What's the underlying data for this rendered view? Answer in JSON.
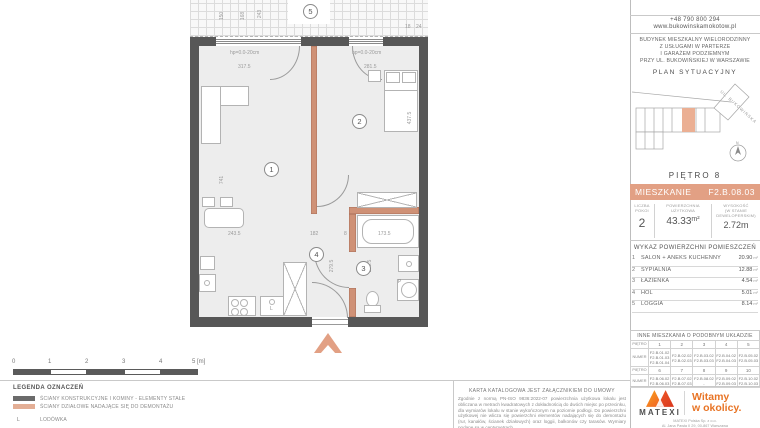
{
  "colors": {
    "accent_salmon": "#E2A084",
    "partition_salmon": "#CF9176",
    "wall_dark": "#575757",
    "logo_orange_1": "#F28C00",
    "logo_orange_2": "#E84E1B",
    "tagline_orange": "#E87425"
  },
  "plan": {
    "room_numbers": [
      "1",
      "2",
      "3",
      "4",
      "5"
    ],
    "dims": {
      "hp_left": "hp=0.0-20cm",
      "hp_right": "hp=0.0-20cm",
      "top_left": "317.5",
      "top_right": "281.5",
      "left_height": "741",
      "right_height": "437.5",
      "bottom_1": "243.5",
      "bottom_2": "182",
      "bottom_3": "8",
      "bottom_4": "173.5",
      "vert_1": "279.5",
      "vert_2": "273.5",
      "loggia_1": "150",
      "loggia_2": "168",
      "loggia_3": "243",
      "loggia_4": "18",
      "loggia_5": "24"
    },
    "labels": {
      "fridge": "L",
      "washer": "P"
    }
  },
  "scalebar": {
    "labels": [
      "0",
      "1",
      "2",
      "3",
      "4"
    ],
    "end_label": "5 [m]"
  },
  "legend": {
    "title": "LEGENDA OZNACZEŃ",
    "items": [
      {
        "swatch": "dark",
        "label": "ŚCIANY KONSTRUKCYJNE I KOMINY - ELEMENTY STAŁE"
      },
      {
        "swatch": "salmon",
        "label": "ŚCIANY DZIAŁOWE NADAJĄCE SIĘ DO DEMONTAŻU"
      },
      {
        "symbol": "L",
        "label": "LODÓWKA"
      }
    ]
  },
  "disclaimer": {
    "heading": "KARTA KATALOGOWA JEST ZAŁĄCZNIKIEM DO UMOWY",
    "body": "Zgodnie z normą PN-ISO 9836:2022-07 powierzchnia użytkowa lokalu jest obliczana w metrach kwadratowych z dokładnością do dwóch miejsc po przecinku, dla wymiarów lokalu w stanie wykończonym na poziomie podłogi. Do powierzchni użytkowej nie wlicza się powierzchni elementów nadających się do demontażu (rur, kanałów, ścianek działowych) oraz loggii, balkonów czy tarasów. Wymiary podane są w centymetrach."
  },
  "panel": {
    "phone": "+48 790 800 294",
    "website": "www.bukowinskamokotow.pl",
    "building_lines": [
      "BUDYNEK MIESZKALNY WIELORODZINNY",
      "Z USŁUGAMI W PARTERZE",
      "I GARAŻEM PODZIEMNYM",
      "PRZY UL. BUKOWIŃSKIEJ W WARSZAWIE"
    ],
    "site_plan_title": "PLAN SYTUACYJNY",
    "street_label": "UL. BUKOWIŃSKA",
    "compass_n": "N",
    "floor_title": "PIĘTRO 8",
    "apartment": {
      "label": "MIESZKANIE",
      "code": "F2.B.08.03"
    },
    "stats": {
      "rooms": {
        "label_lines": [
          "LICZBA POKOI"
        ],
        "value": "2"
      },
      "area": {
        "label_lines": [
          "POWIERZCHNIA",
          "UŻYTKOWA"
        ],
        "value": "43.33",
        "unit": "m²"
      },
      "height": {
        "label_lines": [
          "WYSOKOŚĆ",
          "(W STANIE",
          "DEWELOPERSKIM)"
        ],
        "value": "2.72m"
      }
    },
    "areas": {
      "title": "WYKAZ POWIERZCHNI POMIESZCZEŃ",
      "unit": "m²",
      "rows": [
        {
          "no": "1",
          "name": "SALON + ANEKS KUCHENNY",
          "area": "20.90"
        },
        {
          "no": "2",
          "name": "SYPIALNIA",
          "area": "12.88"
        },
        {
          "no": "3",
          "name": "ŁAZIENKA",
          "area": "4.54"
        },
        {
          "no": "4",
          "name": "HOL",
          "area": "5.01"
        },
        {
          "no": "5",
          "name": "LOGGIA",
          "area": "8.14"
        }
      ]
    },
    "similar": {
      "title": "INNE MIESZKANIA O PODOBNYM UKŁADZIE",
      "row_labels": [
        "PIĘTRO",
        "NUMER"
      ],
      "groups": [
        {
          "floors": [
            "1",
            "2",
            "3",
            "4",
            "5"
          ],
          "nums": [
            [
              "F2.B.01.02",
              "F2.B.01.03",
              "F2.B.01.04"
            ],
            [
              "F2.B.02.02",
              "F2.B.02.03"
            ],
            [
              "F2.B.03.02",
              "F2.B.03.03"
            ],
            [
              "F2.B.04.02",
              "F2.B.04.03"
            ],
            [
              "F2.B.05.02",
              "F2.B.05.03"
            ]
          ]
        },
        {
          "floors": [
            "6",
            "7",
            "8",
            "9",
            "10"
          ],
          "nums": [
            [
              "F2.B.06.02",
              "F2.B.06.03"
            ],
            [
              "F2.B.07.02",
              "F2.B.07.03"
            ],
            [
              "F2.B.08.02",
              "-"
            ],
            [
              "F2.B.09.02",
              "F2.B.09.03"
            ],
            [
              "F2.B.10.02",
              "F2.B.10.03"
            ]
          ]
        }
      ]
    }
  },
  "brand": {
    "name": "MATEXI",
    "tagline_line1": "Witamy",
    "tagline_line2": "w okolicy.",
    "company": "MATEXI Polska Sp. z o.o.",
    "address": "Al. Jana Pawła II 29, 00-867 Warszawa"
  }
}
